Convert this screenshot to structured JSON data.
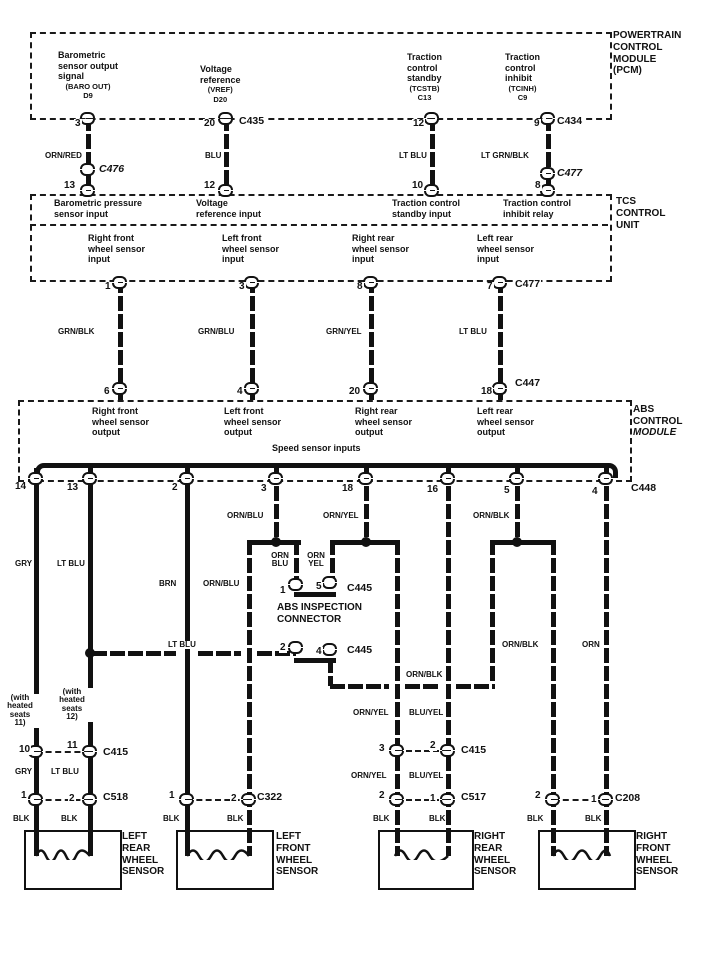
{
  "diagram": {
    "pcm": {
      "title": "POWERTRAIN\nCONTROL\nMODULE\n(PCM)",
      "signals": [
        {
          "name": "Barometric\nsensor output\nsignal",
          "code": "(BARO OUT)",
          "ref": "D9"
        },
        {
          "name": "Voltage\nreference",
          "code": "(VREF)",
          "ref": "D20"
        },
        {
          "name": "Traction\ncontrol\nstandby",
          "code": "(TCSTB)",
          "ref": "C13"
        },
        {
          "name": "Traction\ncontrol\ninhibit",
          "code": "(TCINH)",
          "ref": "C9"
        }
      ],
      "pins": [
        "3",
        "20",
        "12",
        "9"
      ],
      "connectors": [
        "C435",
        "C434"
      ]
    },
    "harness_pcm_tcs": {
      "wires": [
        "ORN/RED",
        "BLU",
        "LT BLU",
        "LT GRN/BLK"
      ],
      "connectors": [
        "C476",
        "C477"
      ],
      "tcs_pins": [
        "13",
        "12",
        "10",
        "8"
      ]
    },
    "tcs": {
      "title": "TCS\nCONTROL\nUNIT",
      "inputs": [
        "Barometric pressure\nsensor input",
        "Voltage\nreference input",
        "Traction control\nstandby input",
        "Traction control\ninhibit relay"
      ],
      "sensor_inputs": [
        "Right front\nwheel sensor\ninput",
        "Left front\nwheel sensor\ninput",
        "Right rear\nwheel sensor\ninput",
        "Left rear\nwheel sensor\ninput"
      ],
      "pins": [
        "1",
        "3",
        "8",
        "7"
      ],
      "connector": "C477"
    },
    "harness_tcs_abs": {
      "wires": [
        "GRN/BLK",
        "GRN/BLU",
        "GRN/YEL",
        "LT BLU"
      ],
      "abs_pins": [
        "6",
        "4",
        "20",
        "18"
      ],
      "connector": "C447"
    },
    "abs": {
      "title_line1": "ABS\nCONTROL",
      "title_line2": "MODULE",
      "outputs": [
        "Right front\nwheel sensor\noutput",
        "Left front\nwheel sensor\noutput",
        "Right rear\nwheel sensor\noutput",
        "Left rear\nwheel sensor\noutput"
      ],
      "bus_label": "Speed sensor inputs",
      "pins": [
        "14",
        "13",
        "2",
        "3",
        "18",
        "16",
        "5",
        "4"
      ],
      "connector": "C448"
    },
    "wires": {
      "gry": "GRY",
      "lt_blu": "LT BLU",
      "brn": "BRN",
      "orn_blu": "ORN/BLU",
      "orn_yel": "ORN/YEL",
      "orn_blk": "ORN/BLK",
      "blu_yel": "BLU/YEL",
      "orn": "ORN",
      "blk": "BLK",
      "orn_blu_stack": "ORN\nBLU",
      "orn_yel_stack": "ORN\nYEL",
      "note_heated_11": "(with\nheated\nseats\n11)",
      "note_heated_12": "(with\nheated\nseats\n12)"
    },
    "inspection": {
      "title": "ABS INSPECTION\nCONNECTOR",
      "top": {
        "pins": [
          "1",
          "5"
        ],
        "connector": "C445"
      },
      "bottom": {
        "pins": [
          "2",
          "4"
        ],
        "connector": "C445"
      }
    },
    "connectors": {
      "c415_left": {
        "pins": [
          "10",
          "11"
        ],
        "name": "C415"
      },
      "c518": {
        "pins": [
          "1",
          "2"
        ],
        "name": "C518"
      },
      "c322": {
        "pins": [
          "1",
          "2"
        ],
        "name": "C322"
      },
      "c415_right": {
        "pins": [
          "3",
          "2"
        ],
        "name": "C415"
      },
      "c517": {
        "pins": [
          "2",
          "1"
        ],
        "name": "C517"
      },
      "c208": {
        "pins": [
          "2",
          "1"
        ],
        "name": "C208"
      }
    },
    "sensors": [
      {
        "name": "LEFT\nREAR\nWHEEL\nSENSOR"
      },
      {
        "name": "LEFT\nFRONT\nWHEEL\nSENSOR"
      },
      {
        "name": "RIGHT\nREAR\nWHEEL\nSENSOR"
      },
      {
        "name": "RIGHT\nFRONT\nWHEEL\nSENSOR"
      }
    ]
  }
}
